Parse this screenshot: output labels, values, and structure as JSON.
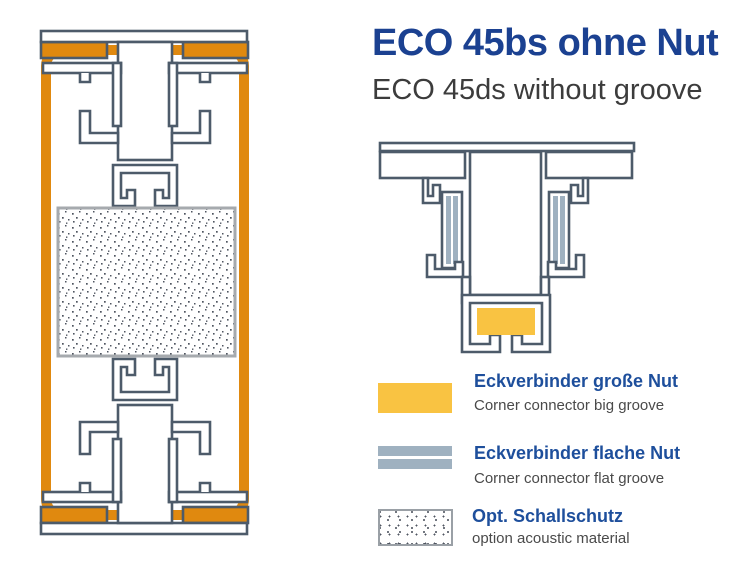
{
  "header": {
    "title": "ECO 45bs ohne Nut",
    "subtitle": "ECO 45ds without groove"
  },
  "legend": {
    "items": [
      {
        "id": "corner-connector-big-groove",
        "swatch": "orange-filled-rect",
        "label_de": "Eckverbinder große Nut",
        "label_en": "Corner connector big groove"
      },
      {
        "id": "corner-connector-flat-groove",
        "swatch": "two-steel-blue-bars",
        "label_de": "Eckverbinder flache Nut",
        "label_en": "Corner connector flat groove"
      },
      {
        "id": "optional-acoustic-material",
        "swatch": "dotted-rect",
        "label_de": "Opt. Schallschutz",
        "label_en": "option acoustic material"
      }
    ]
  },
  "diagrams": {
    "left": {
      "parts": [
        "frame-profile-cross-section-pair",
        "orange-frame-outline",
        "corner-connector-big-groove-fills",
        "acoustic-material-dotted-block"
      ]
    },
    "right": {
      "parts": [
        "mullion-profile-cross-section",
        "corner-connector-flat-groove-strips",
        "corner-connector-big-groove-fill"
      ]
    }
  },
  "colors": {
    "outline": "#4d5b6a",
    "connector_big_groove_light": "#F9C342",
    "connector_big_groove_dark": "#E0890F",
    "connector_flat_groove": "#9fb1c0",
    "title_blue": "#1b4191",
    "label_blue": "#1e4f9c",
    "text_gray": "#4a4a4a",
    "dot_color": "#4f5560"
  }
}
